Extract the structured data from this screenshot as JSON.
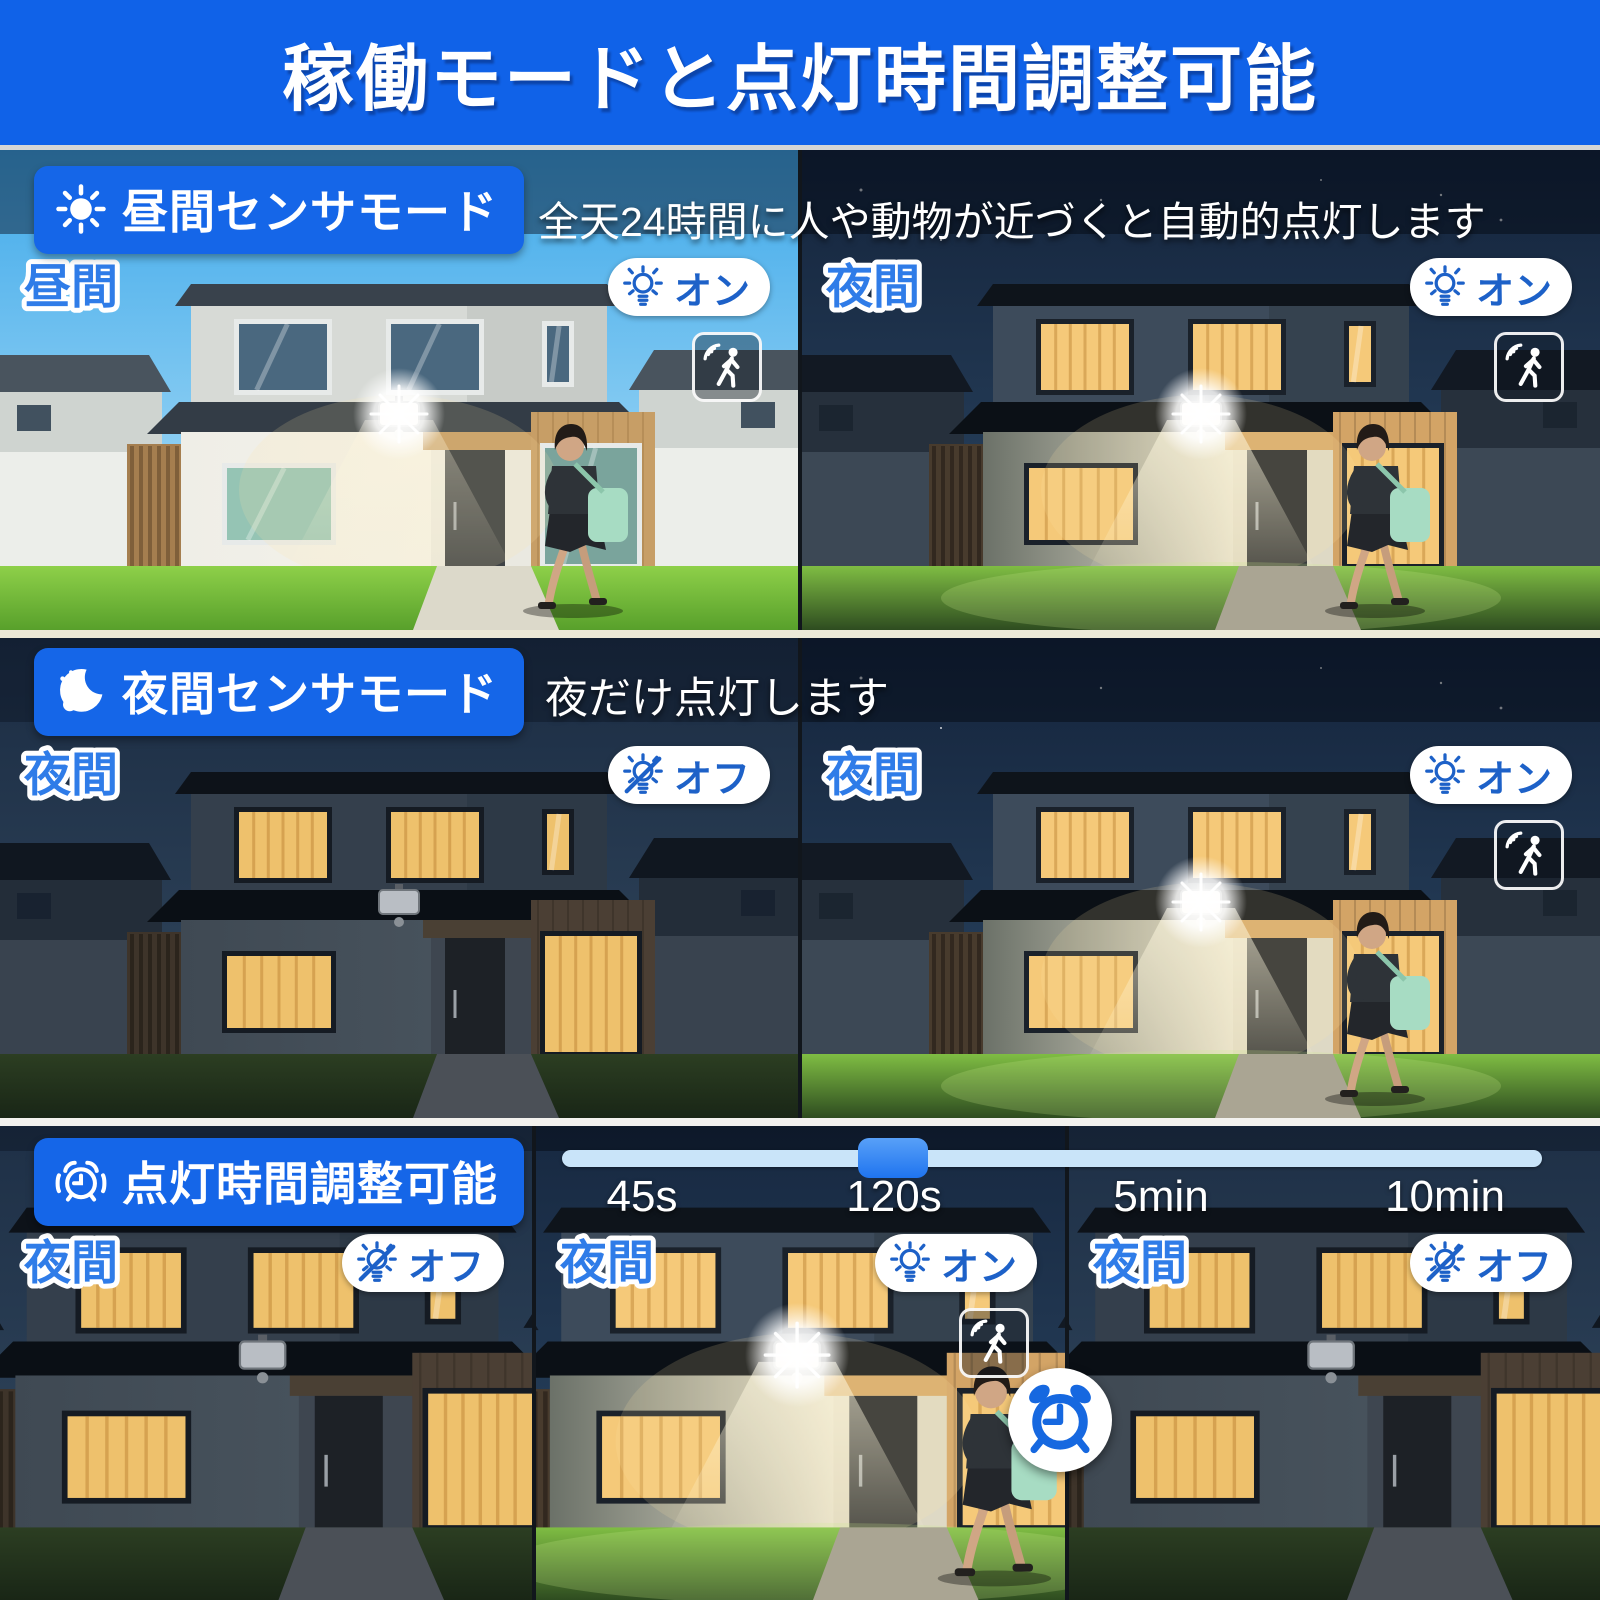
{
  "banner": {
    "title": "稼働モードと点灯時間調整可能"
  },
  "colors": {
    "banner_blue": "#1062e8",
    "badge_blue": "#1566e8",
    "corner_label_blue": "#2f7ce8",
    "pill_text_blue": "#1d61c8",
    "slider_track": "#c9e4f9",
    "slider_handle": "#2f86f4"
  },
  "sections": [
    {
      "id": "daytime-sensor-mode",
      "badge_icon": "sun-icon",
      "badge_label": "昼間センサモード",
      "description": "全天24時間に人や動物が近づくと自動的点灯します",
      "panels": [
        {
          "corner_label": "昼間",
          "light_label": "オン",
          "light_state": "on",
          "motion_sensor_icon": true,
          "scene": "daytime, floodlight on, woman walking on lawn"
        },
        {
          "corner_label": "夜間",
          "light_label": "オン",
          "light_state": "on",
          "motion_sensor_icon": true,
          "scene": "night, floodlight on, woman walking on lawn"
        }
      ]
    },
    {
      "id": "night-sensor-mode",
      "badge_icon": "moon-icon",
      "badge_label": "夜間センサモード",
      "description": "夜だけ点灯します",
      "panels": [
        {
          "corner_label": "夜間",
          "light_label": "オフ",
          "light_state": "off",
          "motion_sensor_icon": false,
          "scene": "night, floodlight off"
        },
        {
          "corner_label": "夜間",
          "light_label": "オン",
          "light_state": "on",
          "motion_sensor_icon": true,
          "scene": "night, floodlight on, woman walking on lawn"
        }
      ]
    },
    {
      "id": "lighting-duration-adjustable",
      "badge_icon": "alarm-clock-icon",
      "badge_label": "点灯時間調整可能",
      "slider": {
        "options": [
          "45s",
          "120s",
          "5min",
          "10min"
        ],
        "selected": "120s",
        "selected_index": 1
      },
      "panels": [
        {
          "corner_label": "夜間",
          "light_label": "オフ",
          "light_state": "off",
          "motion_sensor_icon": false,
          "clock_icon": false,
          "scene": "night close-up, floodlight off"
        },
        {
          "corner_label": "夜間",
          "light_label": "オン",
          "light_state": "on",
          "motion_sensor_icon": true,
          "clock_icon": true,
          "scene": "night close-up, floodlight on, woman walking"
        },
        {
          "corner_label": "夜間",
          "light_label": "オフ",
          "light_state": "off",
          "motion_sensor_icon": false,
          "clock_icon": false,
          "scene": "night close-up, floodlight off"
        }
      ]
    }
  ]
}
